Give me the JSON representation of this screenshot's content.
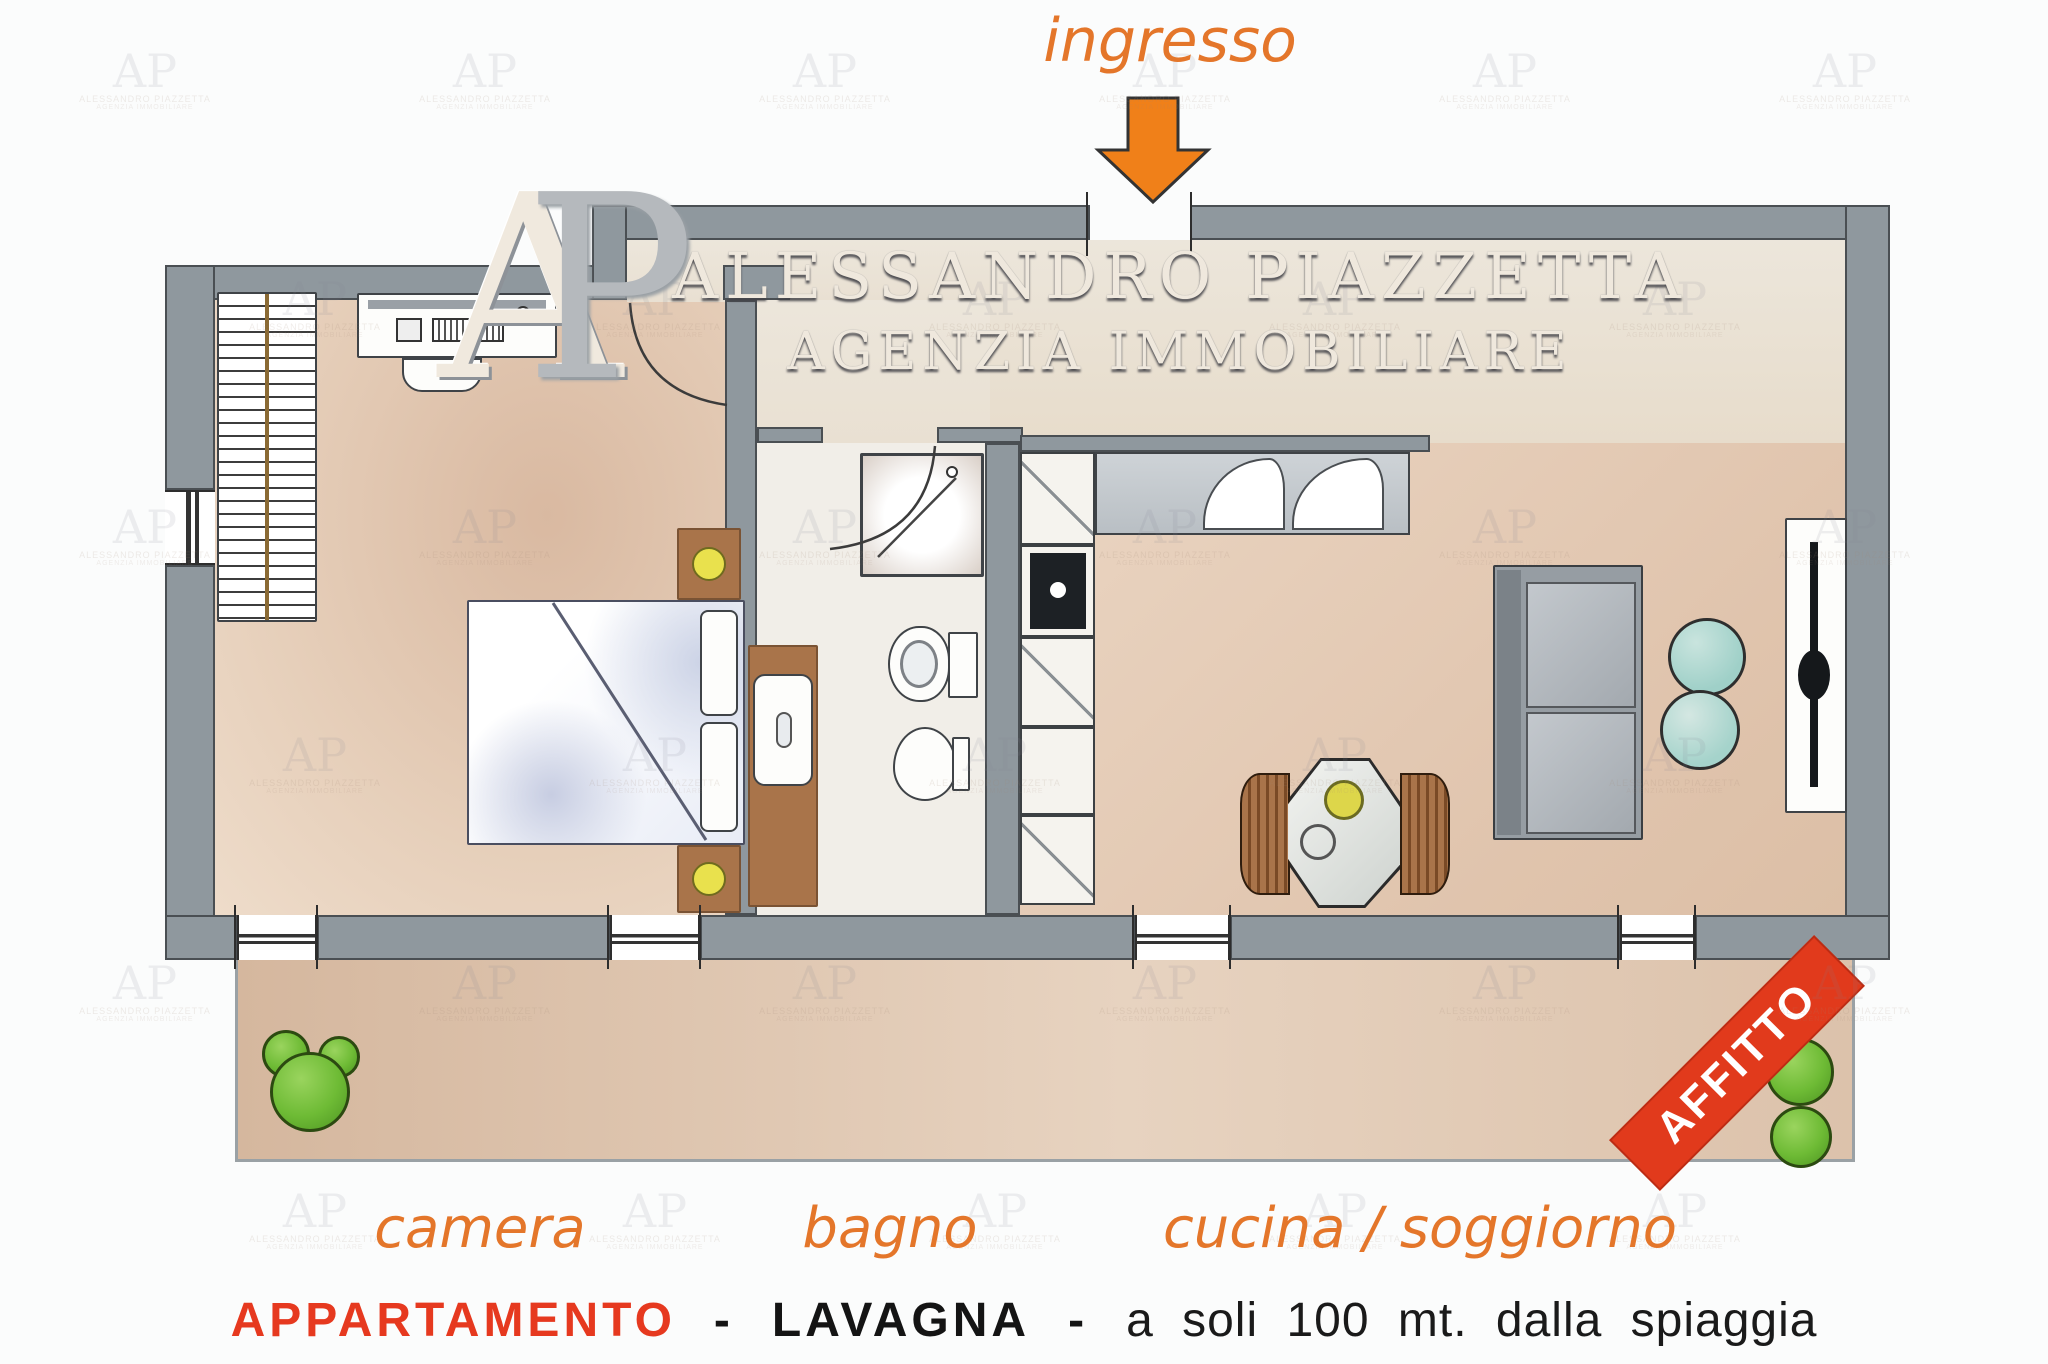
{
  "agency": {
    "logo_initials": "AP",
    "name_line1": "ALESSANDRO PIAZZETTA",
    "name_line2": "AGENZIA IMMOBILIARE"
  },
  "watermark": {
    "initials": "AP",
    "line1": "ALESSANDRO PIAZZETTA",
    "line2": "AGENZIA IMMOBILIARE"
  },
  "plan_labels": {
    "entrance": "ingresso",
    "bedroom": "camera",
    "bathroom": "bagno",
    "kitchen_living": "cucina / soggiorno"
  },
  "banner": {
    "text": "AFFITTO",
    "color": "#e13a1c"
  },
  "caption": {
    "property_type": "APPARTAMENTO",
    "separator1": "-",
    "location": "LAVAGNA",
    "separator2": "-",
    "tagline": "a soli 100 mt. dalla spiaggia",
    "accent_color": "#e6391f"
  },
  "colors": {
    "label_orange": "#e4762a",
    "arrow_orange": "#f08019",
    "wall_gray": "#8f989e",
    "floor_tan": "#ddc0a9",
    "floor_cream": "#ece6db",
    "plant_green": "#6ebb35",
    "wood_brown": "#a9744a",
    "chair_teal": "#a8d5ce"
  }
}
